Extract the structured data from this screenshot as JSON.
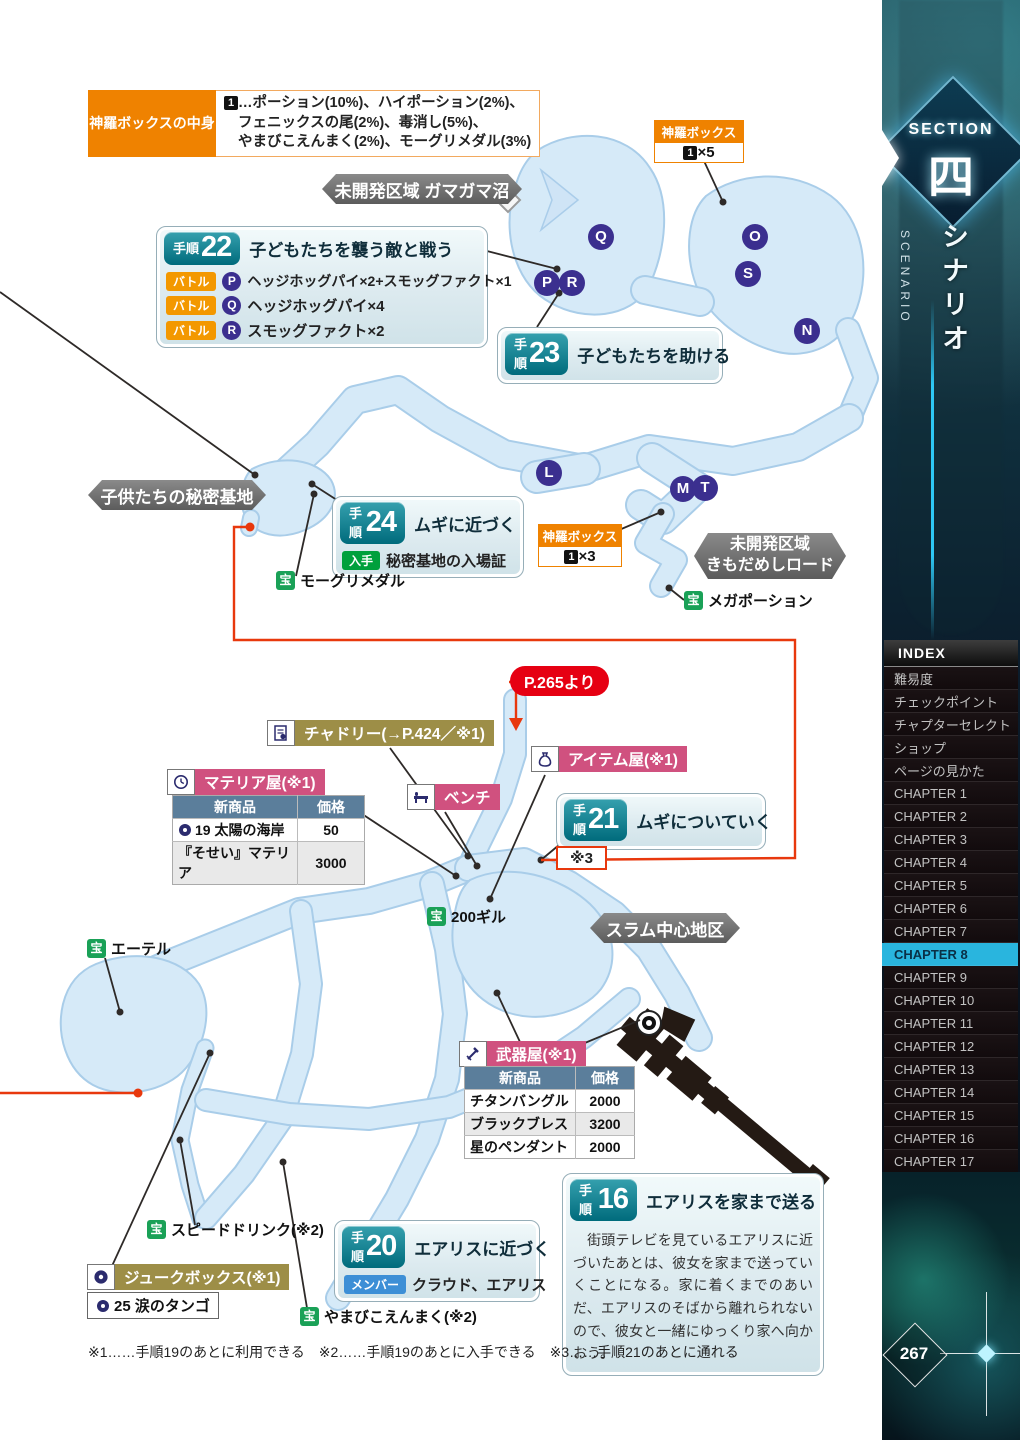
{
  "legend": {
    "title": "神羅ボックスの中身",
    "marker": "1",
    "line1": "…ポーション(10%)、ハイポーション(2%)、",
    "line2": "フェニックスの尾(2%)、毒消し(5%)、",
    "line3": "やまびこえんまく(2%)、モーグリメダル(3%)"
  },
  "shinra_top": {
    "title": "神羅ボックス",
    "marker": "1",
    "count": "×5"
  },
  "shinra_mid": {
    "title": "神羅ボックス",
    "marker": "1",
    "count": "×3"
  },
  "areas": {
    "gamagama": "未開発区域 ガマガマ沼",
    "secret_base": "子供たちの秘密基地",
    "kimodameshi1": "未開発区域",
    "kimodameshi2": "きもだめしロード",
    "slum": "スラム中心地区"
  },
  "steps": {
    "s22": {
      "tag": "手順",
      "num": "22",
      "title": "子どもたちを襲う敵と戦う",
      "battles": [
        {
          "badge": "バトル",
          "letter": "P",
          "text": "ヘッジホッグパイ×2+スモッグファクト×1"
        },
        {
          "badge": "バトル",
          "letter": "Q",
          "text": "ヘッジホッグパイ×4"
        },
        {
          "badge": "バトル",
          "letter": "R",
          "text": "スモッグファクト×2"
        }
      ]
    },
    "s23": {
      "tag": "手順",
      "num": "23",
      "title": "子どもたちを助ける"
    },
    "s24": {
      "tag": "手順",
      "num": "24",
      "title": "ムギに近づく",
      "get_badge": "入手",
      "get_text": "秘密基地の入場証"
    },
    "s21": {
      "tag": "手順",
      "num": "21",
      "title": "ムギについていく"
    },
    "s20": {
      "tag": "手順",
      "num": "20",
      "title": "エアリスに近づく",
      "member_badge": "メンバー",
      "member_text": "クラウド、エアリス"
    },
    "s16": {
      "tag": "手順",
      "num": "16",
      "title": "エアリスを家まで送る",
      "body": "　街頭テレビを見ているエアリスに近づいたあとは、彼女を家まで送っていくことになる。家に着くまでのあいだ、エアリスのそばから離れられないので、彼女と一緒にゆっくり家へ向かおう。"
    }
  },
  "treasures": [
    {
      "badge": "宝",
      "name": "モーグリメダル"
    },
    {
      "badge": "宝",
      "name": "メガポーション"
    },
    {
      "badge": "宝",
      "name": "200ギル"
    },
    {
      "badge": "宝",
      "name": "エーテル"
    },
    {
      "badge": "宝",
      "name": "スピードドリンク(※2)"
    },
    {
      "badge": "宝",
      "name": "やまびこえんまく(※2)"
    }
  ],
  "shops": {
    "chadley": {
      "label": "チャドリー(→P.424／※1)"
    },
    "item_shop": {
      "label": "アイテム屋(※1)"
    },
    "bench": {
      "label": "ベンチ"
    },
    "materia_shop": {
      "label": "マテリア屋(※1)",
      "headers": [
        "新商品",
        "価格"
      ],
      "rows": [
        {
          "name": "19 太陽の海岸",
          "price": "50"
        },
        {
          "name": "『そせい』マテリア",
          "price": "3000"
        }
      ]
    },
    "weapon_shop": {
      "label": "武器屋(※1)",
      "headers": [
        "新商品",
        "価格"
      ],
      "rows": [
        {
          "name": "チタンバングル",
          "price": "2000"
        },
        {
          "name": "ブラックブレス",
          "price": "3200"
        },
        {
          "name": "星のペンダント",
          "price": "2000"
        }
      ]
    },
    "jukebox": {
      "label": "ジュークボックス(※1)",
      "track": "25 涙のタンゴ"
    }
  },
  "route": {
    "from_page": "P.265より",
    "note": "※3"
  },
  "markers": [
    "Q",
    "P",
    "R",
    "O",
    "S",
    "N",
    "L",
    "M",
    "T"
  ],
  "footnote": "※1……手順19のあとに利用できる　※2……手順19のあとに入手できる　※3……手順21のあとに通れる",
  "sidebar": {
    "section_label": "SECTION",
    "section_kanji": "四",
    "scenario_jp": "シナリオ",
    "scenario_en": "SCENARIO",
    "index_title": "INDEX",
    "index_items": [
      "難易度",
      "チェックポイント",
      "チャプターセレクト",
      "ショップ",
      "ページの見かた",
      "CHAPTER 1",
      "CHAPTER 2",
      "CHAPTER 3",
      "CHAPTER 4",
      "CHAPTER 5",
      "CHAPTER 6",
      "CHAPTER 7",
      "CHAPTER 8",
      "CHAPTER 9",
      "CHAPTER 10",
      "CHAPTER 11",
      "CHAPTER 12",
      "CHAPTER 13",
      "CHAPTER 14",
      "CHAPTER 15",
      "CHAPTER 16",
      "CHAPTER 17",
      "CHAPTER 18"
    ],
    "page_number": "267"
  }
}
